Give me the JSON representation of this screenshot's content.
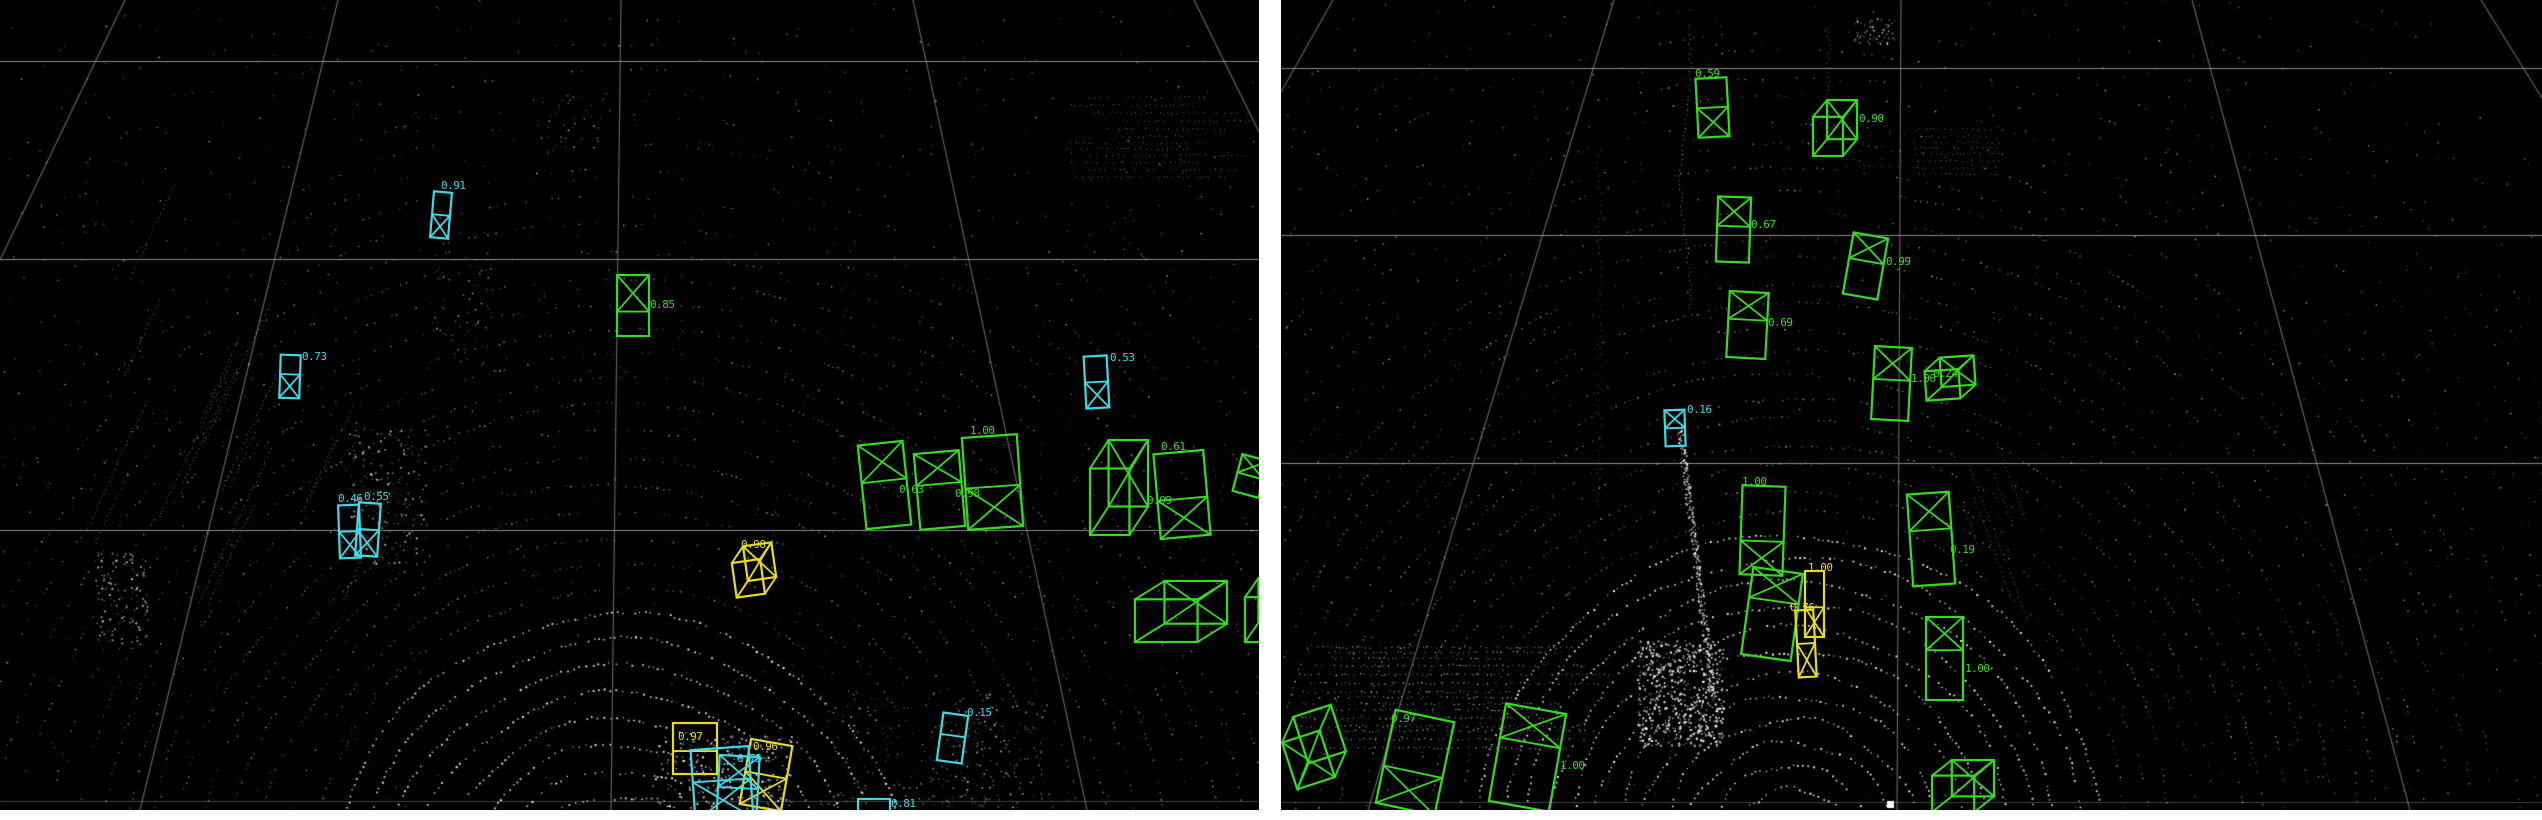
{
  "colors": {
    "page_bg": "#ffffff",
    "panel_bg": "#000000",
    "grid": "#8c8c8c",
    "points": "#ffffff",
    "green": "#35dc1e",
    "cyan": "#3fd9e6",
    "yellow": "#e8dc1c"
  },
  "panels": [
    {
      "name": "lidar-view-left",
      "x": 0,
      "y": 0,
      "width": 1259,
      "height": 810,
      "gridlines": {
        "horizontal": [
          61,
          259,
          530,
          801
        ],
        "diagonal": [
          [
            125,
            0,
            0,
            260
          ],
          [
            338,
            0,
            140,
            810
          ],
          [
            621,
            0,
            611,
            810
          ],
          [
            913,
            0,
            1087,
            810
          ],
          [
            1194,
            0,
            1259,
            132
          ]
        ]
      },
      "detections": [
        {
          "id": "L1",
          "color": "cyan",
          "style": "flat",
          "x": 432,
          "y": 192,
          "w": 18,
          "h": 46,
          "rot": 5,
          "x_mark": "bottom",
          "split": 0.5,
          "label": "0.91",
          "label_pos": [
            441,
            189
          ]
        },
        {
          "id": "L2",
          "color": "cyan",
          "style": "flat",
          "x": 280,
          "y": 355,
          "w": 20,
          "h": 43,
          "rot": 2,
          "x_mark": "bottom",
          "split": 0.45,
          "label": "0.73",
          "label_pos": [
            302,
            360
          ]
        },
        {
          "id": "L3",
          "color": "cyan",
          "style": "flat",
          "x": 339,
          "y": 505,
          "w": 21,
          "h": 53,
          "rot": -2,
          "x_mark": "bottom",
          "split": 0.5,
          "label": "0.46",
          "label_pos": [
            338,
            502
          ]
        },
        {
          "id": "L4",
          "color": "cyan",
          "style": "flat",
          "x": 357,
          "y": 503,
          "w": 22,
          "h": 53,
          "rot": 4,
          "x_mark": "bottom",
          "split": 0.5,
          "label": "0.55",
          "label_pos": [
            364,
            500
          ]
        },
        {
          "id": "L5",
          "color": "green",
          "style": "flat",
          "x": 617,
          "y": 275,
          "w": 32,
          "h": 61,
          "rot": 0,
          "x_mark": "top",
          "split": 0.6,
          "label": "0.85",
          "label_pos": [
            650,
            308
          ]
        },
        {
          "id": "L6",
          "color": "green",
          "style": "flat",
          "x": 862,
          "y": 443,
          "w": 45,
          "h": 84,
          "rot": -6,
          "x_mark": "top",
          "split": 0.45,
          "label": "0.63",
          "label_pos": [
            899,
            493
          ]
        },
        {
          "id": "L7",
          "color": "green",
          "style": "flat",
          "x": 917,
          "y": 452,
          "w": 45,
          "h": 76,
          "rot": -5,
          "x_mark": "top",
          "split": 0.42,
          "label": "0.98",
          "label_pos": [
            955,
            497
          ]
        },
        {
          "id": "L8",
          "color": "green",
          "style": "flat",
          "x": 965,
          "y": 436,
          "w": 55,
          "h": 92,
          "rot": -4,
          "x_mark": "bottom",
          "split": 0.55,
          "label": "1.00",
          "label_pos": [
            970,
            434
          ]
        },
        {
          "id": "L9",
          "color": "green",
          "style": "persp",
          "x": 1090,
          "y": 440,
          "w": 58,
          "h": 95,
          "rot": 0,
          "x_mark": "top",
          "split": 0.5,
          "label": "0.61",
          "label_pos": [
            1161,
            450
          ]
        },
        {
          "id": "L10",
          "color": "green",
          "style": "flat",
          "x": 1157,
          "y": 452,
          "w": 50,
          "h": 85,
          "rot": -5,
          "x_mark": "bottom",
          "split": 0.55,
          "label": "0.99",
          "label_pos": [
            1147,
            504
          ]
        },
        {
          "id": "L11",
          "color": "green",
          "style": "flat",
          "x": 1237,
          "y": 457,
          "w": 27,
          "h": 38,
          "rot": 15,
          "x_mark": "top",
          "split": 0.5,
          "label": null,
          "label_pos": null
        },
        {
          "id": "L12",
          "color": "green",
          "style": "persp",
          "x": 1135,
          "y": 581,
          "w": 92,
          "h": 61,
          "rot": 0,
          "x_mark": "top",
          "split": 0.5,
          "label": null,
          "label_pos": null
        },
        {
          "id": "L13",
          "color": "green",
          "style": "persp",
          "x": 1245,
          "y": 578,
          "w": 42,
          "h": 64,
          "rot": 0,
          "x_mark": "top",
          "split": 0.5,
          "label": null,
          "label_pos": null
        },
        {
          "id": "L14",
          "color": "yellow",
          "style": "persp",
          "x": 733,
          "y": 545,
          "w": 42,
          "h": 50,
          "rot": -8,
          "x_mark": "top",
          "split": 0.5,
          "label": "0.98",
          "label_pos": [
            741,
            548
          ]
        },
        {
          "id": "L15",
          "color": "yellow",
          "style": "flat",
          "x": 673,
          "y": 723,
          "w": 44,
          "h": 51,
          "rot": 0,
          "x_mark": "none",
          "split": 0.55,
          "label": "0.97",
          "label_pos": [
            678,
            740
          ]
        },
        {
          "id": "L16",
          "color": "yellow",
          "style": "flat",
          "x": 745,
          "y": 742,
          "w": 42,
          "h": 66,
          "rot": 10,
          "x_mark": "bottom",
          "split": 0.5,
          "label": "0.96",
          "label_pos": [
            753,
            750
          ]
        },
        {
          "id": "L17",
          "color": "cyan",
          "style": "flat",
          "x": 693,
          "y": 748,
          "w": 58,
          "h": 72,
          "rot": -4,
          "x_mark": "bottom",
          "split": 0.45,
          "label": "0.75",
          "label_pos": [
            737,
            762
          ]
        },
        {
          "id": "L18",
          "color": "cyan",
          "style": "flat",
          "x": 718,
          "y": 756,
          "w": 40,
          "h": 64,
          "rot": 3,
          "x_mark": "top",
          "split": 0.5,
          "label": null,
          "label_pos": null
        },
        {
          "id": "L19",
          "color": "cyan",
          "style": "flat",
          "x": 858,
          "y": 799,
          "w": 32,
          "h": 21,
          "rot": 0,
          "x_mark": "none",
          "split": 0,
          "label": "0.81",
          "label_pos": [
            891,
            807
          ]
        },
        {
          "id": "L20",
          "color": "cyan",
          "style": "flat",
          "x": 940,
          "y": 714,
          "w": 25,
          "h": 48,
          "rot": 8,
          "x_mark": "none",
          "split": 0.45,
          "label": "0.15",
          "label_pos": [
            967,
            716
          ]
        },
        {
          "id": "L21",
          "color": "cyan",
          "style": "flat",
          "x": 1085,
          "y": 356,
          "w": 23,
          "h": 52,
          "rot": -3,
          "x_mark": "bottom",
          "split": 0.5,
          "label": "0.53",
          "label_pos": [
            1110,
            361
          ]
        }
      ]
    },
    {
      "name": "lidar-view-right",
      "x": 1281,
      "y": 0,
      "width": 1261,
      "height": 810,
      "gridlines": {
        "horizontal": [
          68,
          235,
          463,
          802
        ],
        "diagonal": [
          [
            52,
            0,
            0,
            92
          ],
          [
            333,
            0,
            87,
            810
          ],
          [
            620,
            0,
            616,
            810
          ],
          [
            911,
            0,
            1129,
            810
          ],
          [
            1200,
            0,
            1261,
            98
          ]
        ]
      },
      "detections": [
        {
          "id": "R1",
          "color": "green",
          "style": "flat",
          "x": 416,
          "y": 78,
          "w": 31,
          "h": 59,
          "rot": -3,
          "x_mark": "bottom",
          "split": 0.5,
          "label": "0.59",
          "label_pos": [
            414,
            77
          ]
        },
        {
          "id": "R2",
          "color": "green",
          "style": "persp",
          "x": 532,
          "y": 100,
          "w": 44,
          "h": 56,
          "rot": 0,
          "x_mark": "top",
          "split": 0.5,
          "label": "0.90",
          "label_pos": [
            578,
            122
          ]
        },
        {
          "id": "R3",
          "color": "green",
          "style": "flat",
          "x": 436,
          "y": 197,
          "w": 33,
          "h": 65,
          "rot": 2,
          "x_mark": "top",
          "split": 0.45,
          "label": "0.67",
          "label_pos": [
            470,
            228
          ]
        },
        {
          "id": "R4",
          "color": "green",
          "style": "flat",
          "x": 567,
          "y": 235,
          "w": 35,
          "h": 62,
          "rot": 10,
          "x_mark": "top",
          "split": 0.42,
          "label": "0.99",
          "label_pos": [
            605,
            265
          ]
        },
        {
          "id": "R5",
          "color": "green",
          "style": "flat",
          "x": 447,
          "y": 292,
          "w": 39,
          "h": 66,
          "rot": 3,
          "x_mark": "top",
          "split": 0.42,
          "label": "0.69",
          "label_pos": [
            487,
            326
          ]
        },
        {
          "id": "R6",
          "color": "green",
          "style": "flat",
          "x": 592,
          "y": 347,
          "w": 37,
          "h": 73,
          "rot": 3,
          "x_mark": "top",
          "split": 0.45,
          "label": "1.00",
          "label_pos": [
            630,
            382
          ]
        },
        {
          "id": "R7",
          "color": "green",
          "style": "persp",
          "x": 644,
          "y": 357,
          "w": 50,
          "h": 42,
          "rot": -4,
          "x_mark": "top",
          "split": 0.5,
          "label": "0.24",
          "label_pos": [
            652,
            377
          ]
        },
        {
          "id": "R8",
          "color": "green",
          "style": "flat",
          "x": 629,
          "y": 493,
          "w": 42,
          "h": 92,
          "rot": -4,
          "x_mark": "top",
          "split": 0.4,
          "label": "0.19",
          "label_pos": [
            669,
            553
          ]
        },
        {
          "id": "R9",
          "color": "green",
          "style": "flat",
          "x": 645,
          "y": 617,
          "w": 37,
          "h": 83,
          "rot": 0,
          "x_mark": "top",
          "split": 0.4,
          "label": "1.00",
          "label_pos": [
            684,
            672
          ]
        },
        {
          "id": "R10",
          "color": "green",
          "style": "persp",
          "x": 651,
          "y": 760,
          "w": 62,
          "h": 52,
          "rot": 0,
          "x_mark": "top",
          "split": 0.5,
          "label": null,
          "label_pos": null
        },
        {
          "id": "R11",
          "color": "cyan",
          "style": "flat",
          "x": 384,
          "y": 410,
          "w": 20,
          "h": 36,
          "rot": -2,
          "x_mark": "top",
          "split": 0.5,
          "label": "0.16",
          "label_pos": [
            406,
            413
          ]
        },
        {
          "id": "R12",
          "color": "green",
          "style": "flat",
          "x": 460,
          "y": 486,
          "w": 43,
          "h": 89,
          "rot": 2,
          "x_mark": "bottom",
          "split": 0.62,
          "label": "1.00",
          "label_pos": [
            461,
            485
          ]
        },
        {
          "id": "R13",
          "color": "green",
          "style": "flat",
          "x": 466,
          "y": 570,
          "w": 50,
          "h": 88,
          "rot": 8,
          "x_mark": "top",
          "split": 0.35,
          "label": null,
          "label_pos": null
        },
        {
          "id": "R14",
          "color": "yellow",
          "style": "flat",
          "x": 524,
          "y": 571,
          "w": 19,
          "h": 66,
          "rot": 0,
          "x_mark": "bottom",
          "split": 0.55,
          "label": "1.00",
          "label_pos": [
            527,
            571
          ]
        },
        {
          "id": "R15",
          "color": "yellow",
          "style": "flat",
          "x": 516,
          "y": 610,
          "w": 18,
          "h": 67,
          "rot": -3,
          "x_mark": "bottom",
          "split": 0.5,
          "label": "0.76",
          "label_pos": [
            509,
            611
          ]
        },
        {
          "id": "R16",
          "color": "green",
          "style": "persp",
          "x": 4,
          "y": 712,
          "w": 58,
          "h": 70,
          "rot": -18,
          "x_mark": "bottom",
          "split": 0.5,
          "label": null,
          "label_pos": null
        },
        {
          "id": "R17",
          "color": "green",
          "style": "flat",
          "x": 104,
          "y": 715,
          "w": 60,
          "h": 95,
          "rot": 12,
          "x_mark": "bottom",
          "split": 0.6,
          "label": "0.97",
          "label_pos": [
            110,
            722
          ]
        },
        {
          "id": "R18",
          "color": "green",
          "style": "flat",
          "x": 216,
          "y": 708,
          "w": 61,
          "h": 99,
          "rot": 10,
          "x_mark": "top",
          "split": 0.35,
          "label": "1.00",
          "label_pos": [
            279,
            769
          ]
        }
      ]
    }
  ]
}
